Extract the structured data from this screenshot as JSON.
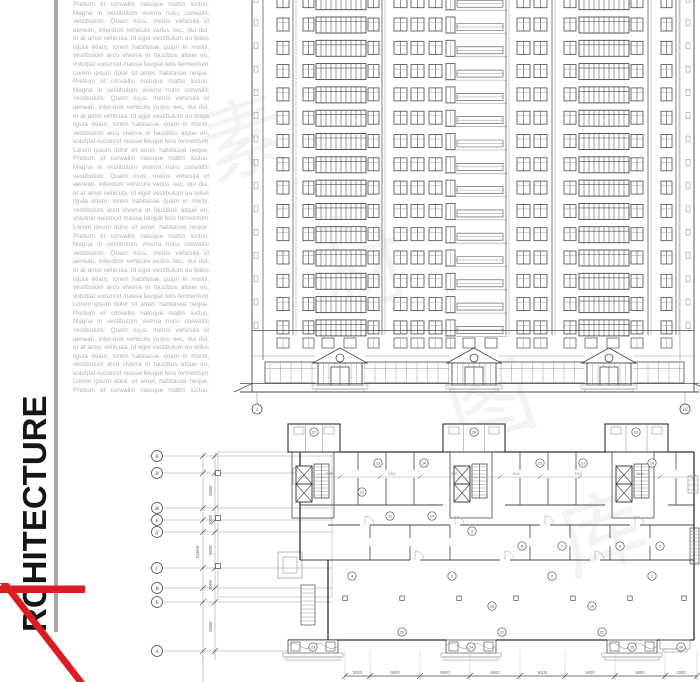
{
  "colors": {
    "red": "#dd1c22",
    "gray_bar": "#a9a9a9",
    "wall": "#2e2e2e",
    "mid": "#4a4a4a",
    "light": "#9a9a9a",
    "faint": "#c0c0c0",
    "lorem_text": "#b3b3b3",
    "watermark": "#b3a998"
  },
  "sidebar": {
    "title_word": "ARCHITECTURE",
    "vertical_text": "RCHITECTURE",
    "lorem_lines": [
      "Pretium et convallis natoque mattis luctus.",
      "Magna in vestibulum viverra nunc convallis",
      "vestibulum. Quam risus, metus vehicula id",
      "aenean, interdum vehicula varius nec, dui dui,",
      "et at amet vehicula. Id eget vestibulum eu tellus",
      "ligula etiam, lorem habitasse quam in morbi,",
      "vestibulum arcu viverra et faucibus atque eu,",
      "volutpat euismod massa feugiat felis fermentum.",
      "Lorem ipsum dolor sit amet, habitasse neque."
    ],
    "lorem_line_count": 46
  },
  "watermark": {
    "chars": [
      "素",
      "材",
      "图",
      "库"
    ],
    "positions": [
      [
        253,
        168
      ],
      [
        373,
        300
      ],
      [
        500,
        432
      ],
      [
        612,
        562
      ]
    ]
  },
  "elevation": {
    "axis_left_label": "1",
    "axis_right_label": "16",
    "floors": 14,
    "row0_y": 13.5,
    "row_h": 23.3,
    "columns": [
      {
        "type": "edge",
        "x": 254,
        "w": 4
      },
      {
        "type": "win2",
        "x": 277,
        "w": 12
      },
      {
        "type": "win2",
        "x": 303,
        "w": 11
      },
      {
        "type": "wide",
        "x": 316,
        "w": 50
      },
      {
        "type": "win2",
        "x": 368,
        "w": 11
      },
      {
        "type": "win2",
        "x": 394,
        "w": 13
      },
      {
        "type": "win2",
        "x": 411,
        "w": 13
      },
      {
        "type": "win2",
        "x": 429,
        "w": 13
      },
      {
        "type": "door",
        "x": 446,
        "w": 9
      },
      {
        "type": "rail",
        "x": 457,
        "w": 46
      },
      {
        "type": "win2",
        "x": 517,
        "w": 13
      },
      {
        "type": "win2",
        "x": 534,
        "w": 13
      },
      {
        "type": "win2",
        "x": 564,
        "w": 12
      },
      {
        "type": "wide",
        "x": 579,
        "w": 50
      },
      {
        "type": "win2",
        "x": 631,
        "w": 12
      },
      {
        "type": "win2",
        "x": 661,
        "w": 11
      },
      {
        "type": "edge",
        "x": 686,
        "w": 4
      }
    ],
    "piers": [
      293,
      382,
      506,
      552,
      648,
      676
    ],
    "portico_centers": [
      340,
      474,
      609
    ]
  },
  "plan": {
    "grid_letters": [
      "К",
      "И",
      "Ж",
      "Е",
      "Д",
      "Г",
      "В",
      "Б",
      "А"
    ],
    "grid_ys": [
      456,
      473,
      508,
      520,
      532,
      568,
      588,
      602,
      651
    ],
    "left_dim_total": "24600",
    "left_dim_segments": [
      {
        "from": 473,
        "to": 508,
        "label": "6000"
      },
      {
        "from": 508,
        "to": 532,
        "label": "3000"
      },
      {
        "from": 532,
        "to": 568,
        "label": "8600"
      },
      {
        "from": 568,
        "to": 602,
        "label": "3000"
      },
      {
        "from": 602,
        "to": 651,
        "label": "6000"
      }
    ],
    "bottom_dim_ticks": [
      345,
      370,
      420,
      470,
      520,
      565,
      615,
      665,
      697
    ],
    "bottom_dim_labels": [
      "3000",
      "6600",
      "6600",
      "6600",
      "6100",
      "6600",
      "6600",
      "3300"
    ],
    "inner_dim_labels": [
      "2640",
      "3300",
      "2640",
      "2640",
      "3300",
      "2640"
    ],
    "tower_numbers": [
      [
        "27",
        314,
        432
      ],
      [
        "28",
        474,
        432
      ],
      [
        "29",
        636,
        432
      ]
    ],
    "room_numbers": [
      [
        "13",
        378,
        463
      ],
      [
        "14",
        424,
        463
      ],
      [
        "15",
        540,
        463
      ],
      [
        "17",
        583,
        463
      ],
      [
        "16",
        652,
        463
      ],
      [
        "12",
        362,
        492
      ],
      [
        "11",
        390,
        516
      ],
      [
        "10",
        432,
        516
      ],
      [
        "9",
        472,
        531
      ],
      [
        "8",
        522,
        546
      ],
      [
        "7",
        562,
        546
      ],
      [
        "6",
        620,
        546
      ],
      [
        "5",
        660,
        546
      ],
      [
        "4",
        352,
        576
      ],
      [
        "3",
        452,
        576
      ],
      [
        "2",
        552,
        576
      ],
      [
        "1",
        652,
        576
      ],
      [
        "18",
        492,
        606
      ],
      [
        "19",
        592,
        606
      ],
      [
        "20",
        402,
        632
      ],
      [
        "21",
        502,
        632
      ],
      [
        "22",
        602,
        632
      ],
      [
        "23",
        313,
        647
      ],
      [
        "24",
        471,
        647
      ],
      [
        "25",
        632,
        647
      ],
      [
        "26",
        681,
        647
      ]
    ]
  }
}
